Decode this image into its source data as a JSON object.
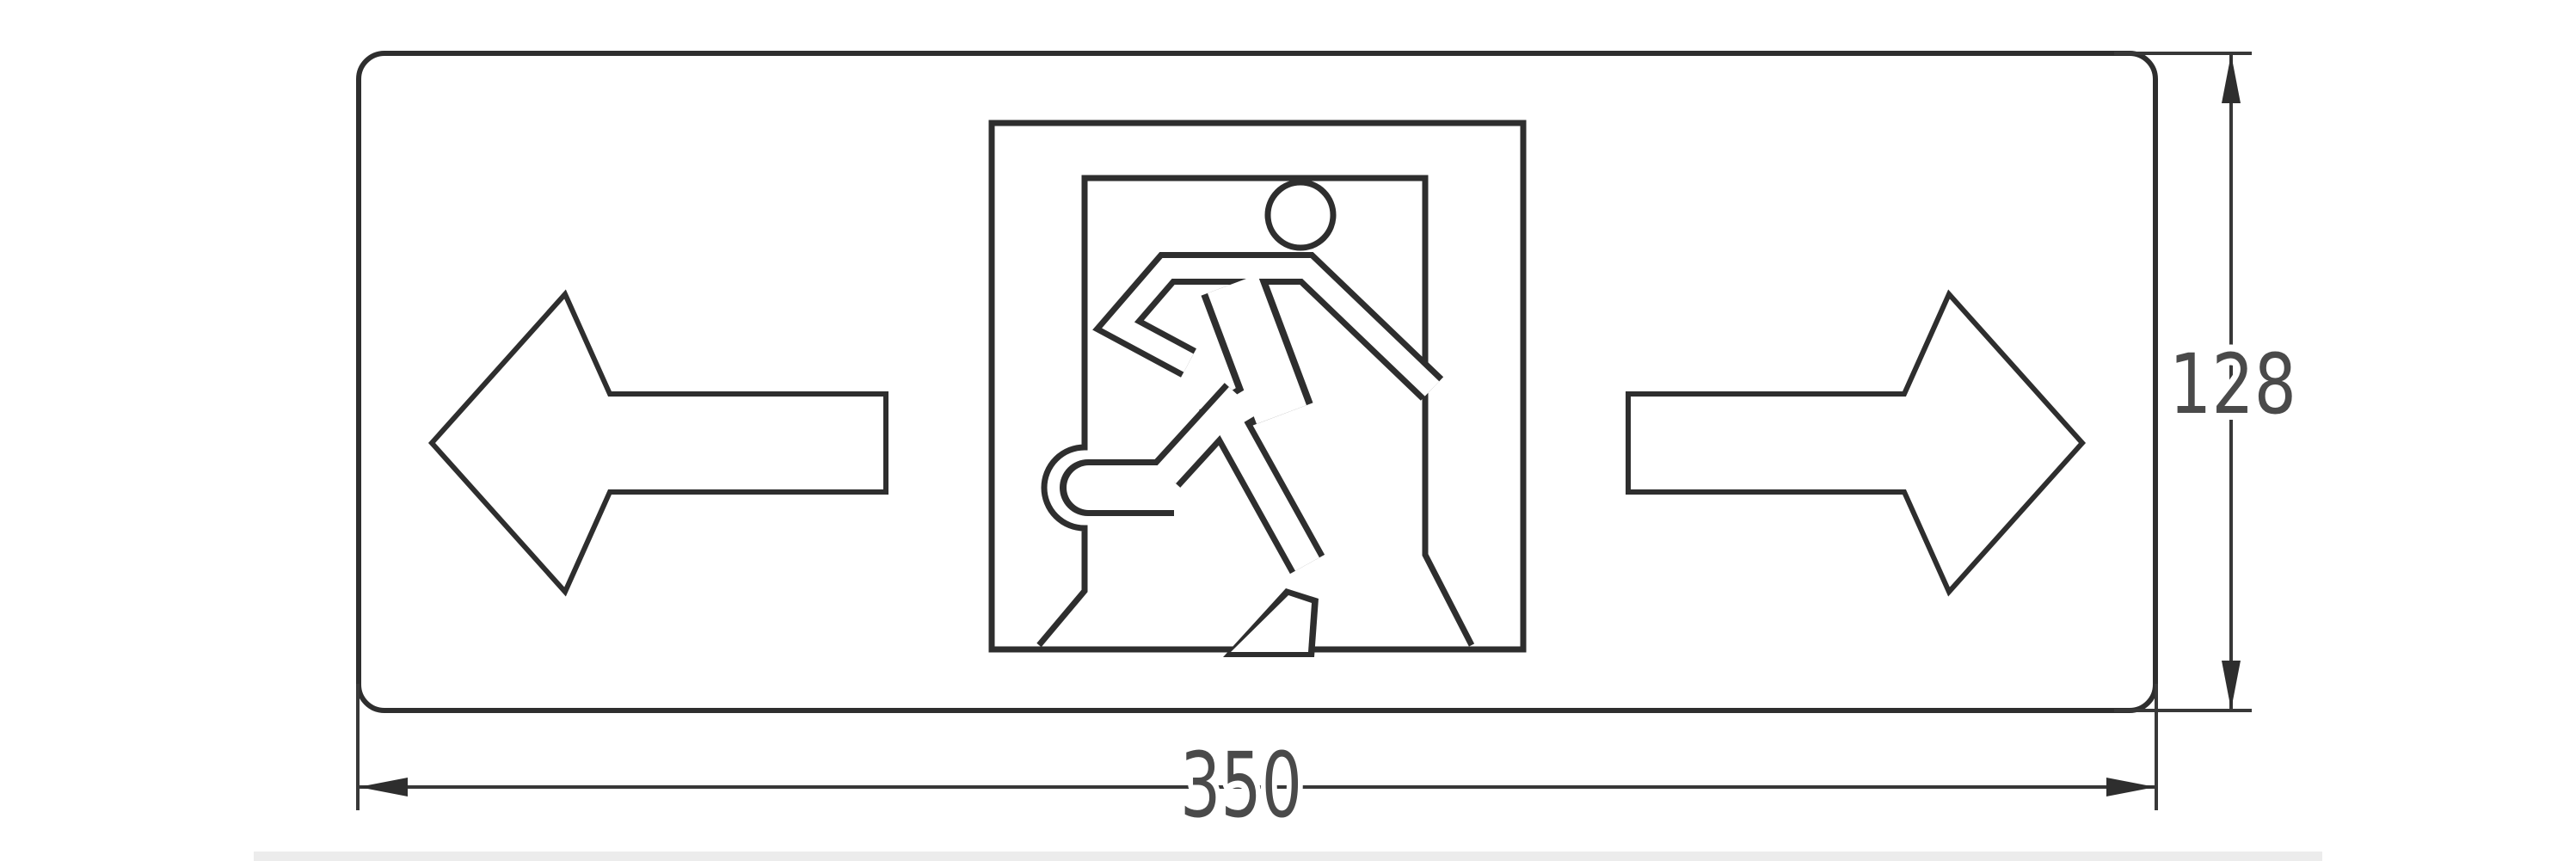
{
  "drawing": {
    "subject": "emergency-exit-sign-dimension-drawing",
    "width_dimension": {
      "value": "350"
    },
    "height_dimension": {
      "value": "128"
    },
    "pictograms": [
      "left-arrow-icon",
      "running-man-exit-door-icon",
      "right-arrow-icon"
    ],
    "colors": {
      "line": "#2e2e2e",
      "dimension_line": "#383838",
      "dimension_text": "#4a4a4a",
      "background": "#ffffff",
      "baseline_bar": "#ececec"
    }
  }
}
